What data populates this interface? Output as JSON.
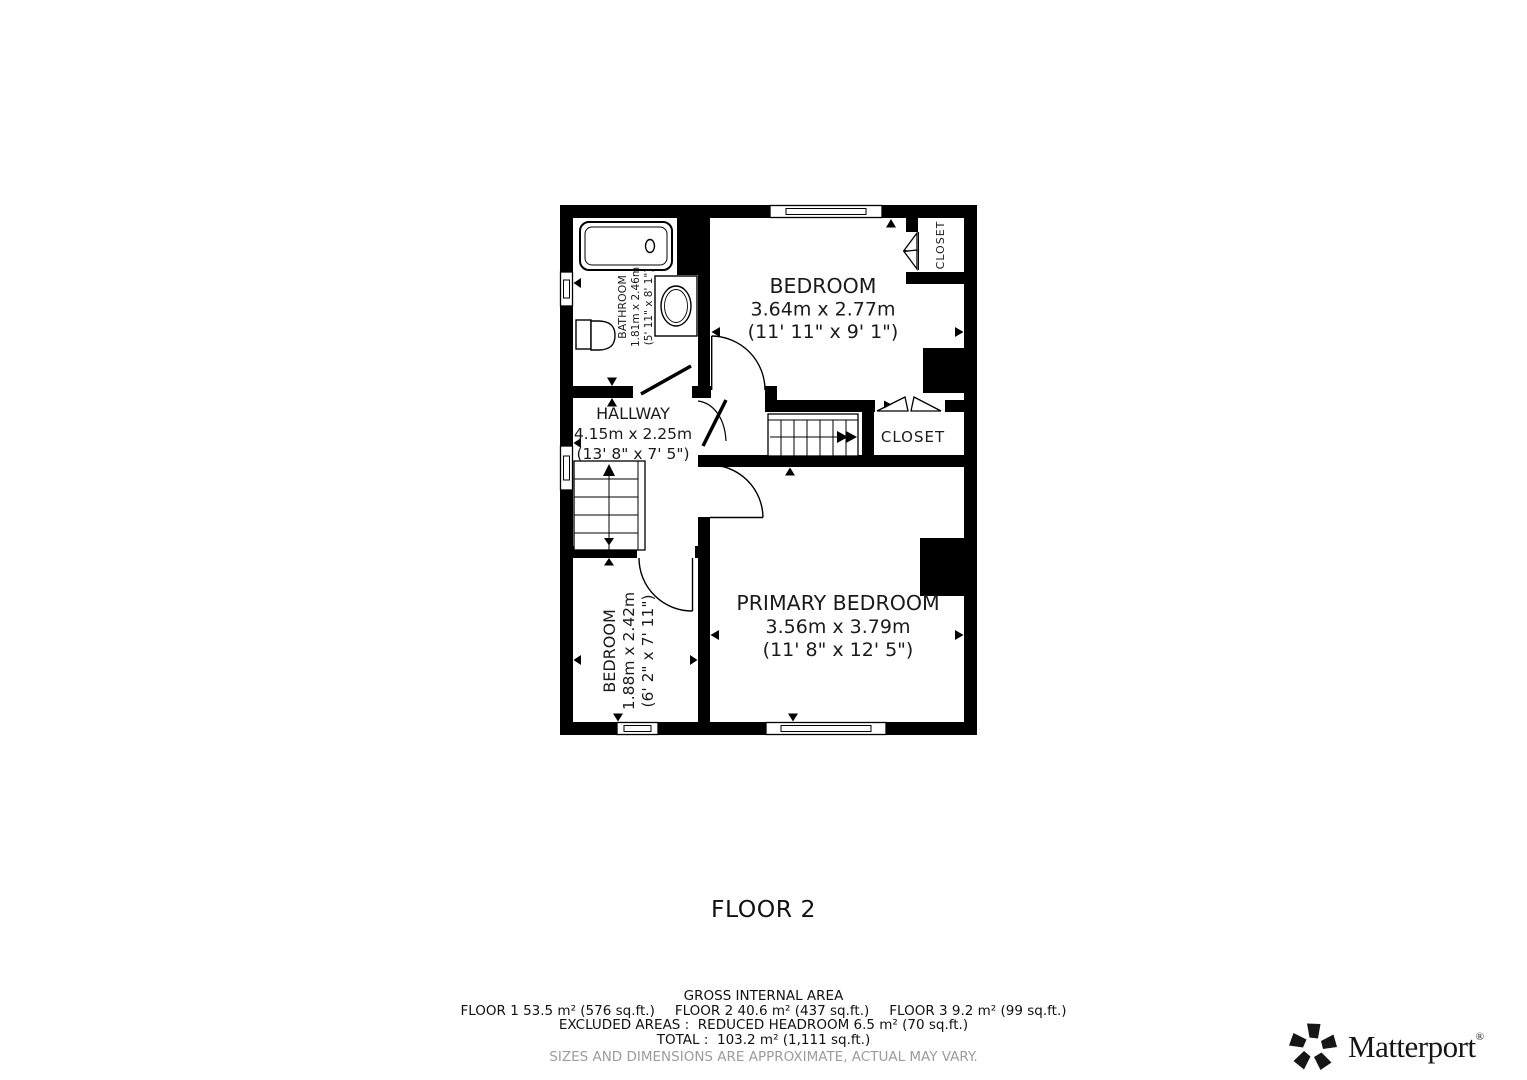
{
  "plan": {
    "floor_label": "FLOOR 2",
    "rooms": {
      "bedroom_top": {
        "name": "BEDROOM",
        "metric": "3.64m x 2.77m",
        "imperial": "(11' 11\" x 9' 1\")"
      },
      "bathroom": {
        "name": "BATHROOM",
        "metric": "1.81m x 2.46m",
        "imperial": "(5' 11\" x 8' 1\")"
      },
      "hallway": {
        "name": "HALLWAY",
        "metric": "4.15m x 2.25m",
        "imperial": "(13' 8\" x 7' 5\")"
      },
      "closet_top": {
        "name": "CLOSET"
      },
      "closet_mid": {
        "name": "CLOSET"
      },
      "primary_bedroom": {
        "name": "PRIMARY BEDROOM",
        "metric": "3.56m x 3.79m",
        "imperial": "(11' 8\" x 12' 5\")"
      },
      "bedroom_bottom": {
        "name": "BEDROOM",
        "metric": "1.88m x 2.42m",
        "imperial": "(6' 2\" x 7' 11\")"
      }
    }
  },
  "footer": {
    "gross_title": "GROSS INTERNAL AREA",
    "floor1": "FLOOR 1 53.5 m² (576 sq.ft.)",
    "floor2": "FLOOR 2 40.6 m² (437 sq.ft.)",
    "floor3": "FLOOR 3 9.2 m² (99 sq.ft.)",
    "excluded_line": "EXCLUDED AREAS :  REDUCED HEADROOM 6.5 m² (70 sq.ft.)",
    "total_line": "TOTAL :  103.2 m² (1,111 sq.ft.)",
    "disclaimer": "SIZES AND DIMENSIONS ARE APPROXIMATE, ACTUAL MAY VARY."
  },
  "branding": {
    "logo_text": "Matterport",
    "registered": "®"
  },
  "colors": {
    "wall": "#000000",
    "text": "#1a1a1a",
    "disclaimer_gray": "#9c9c9c"
  }
}
